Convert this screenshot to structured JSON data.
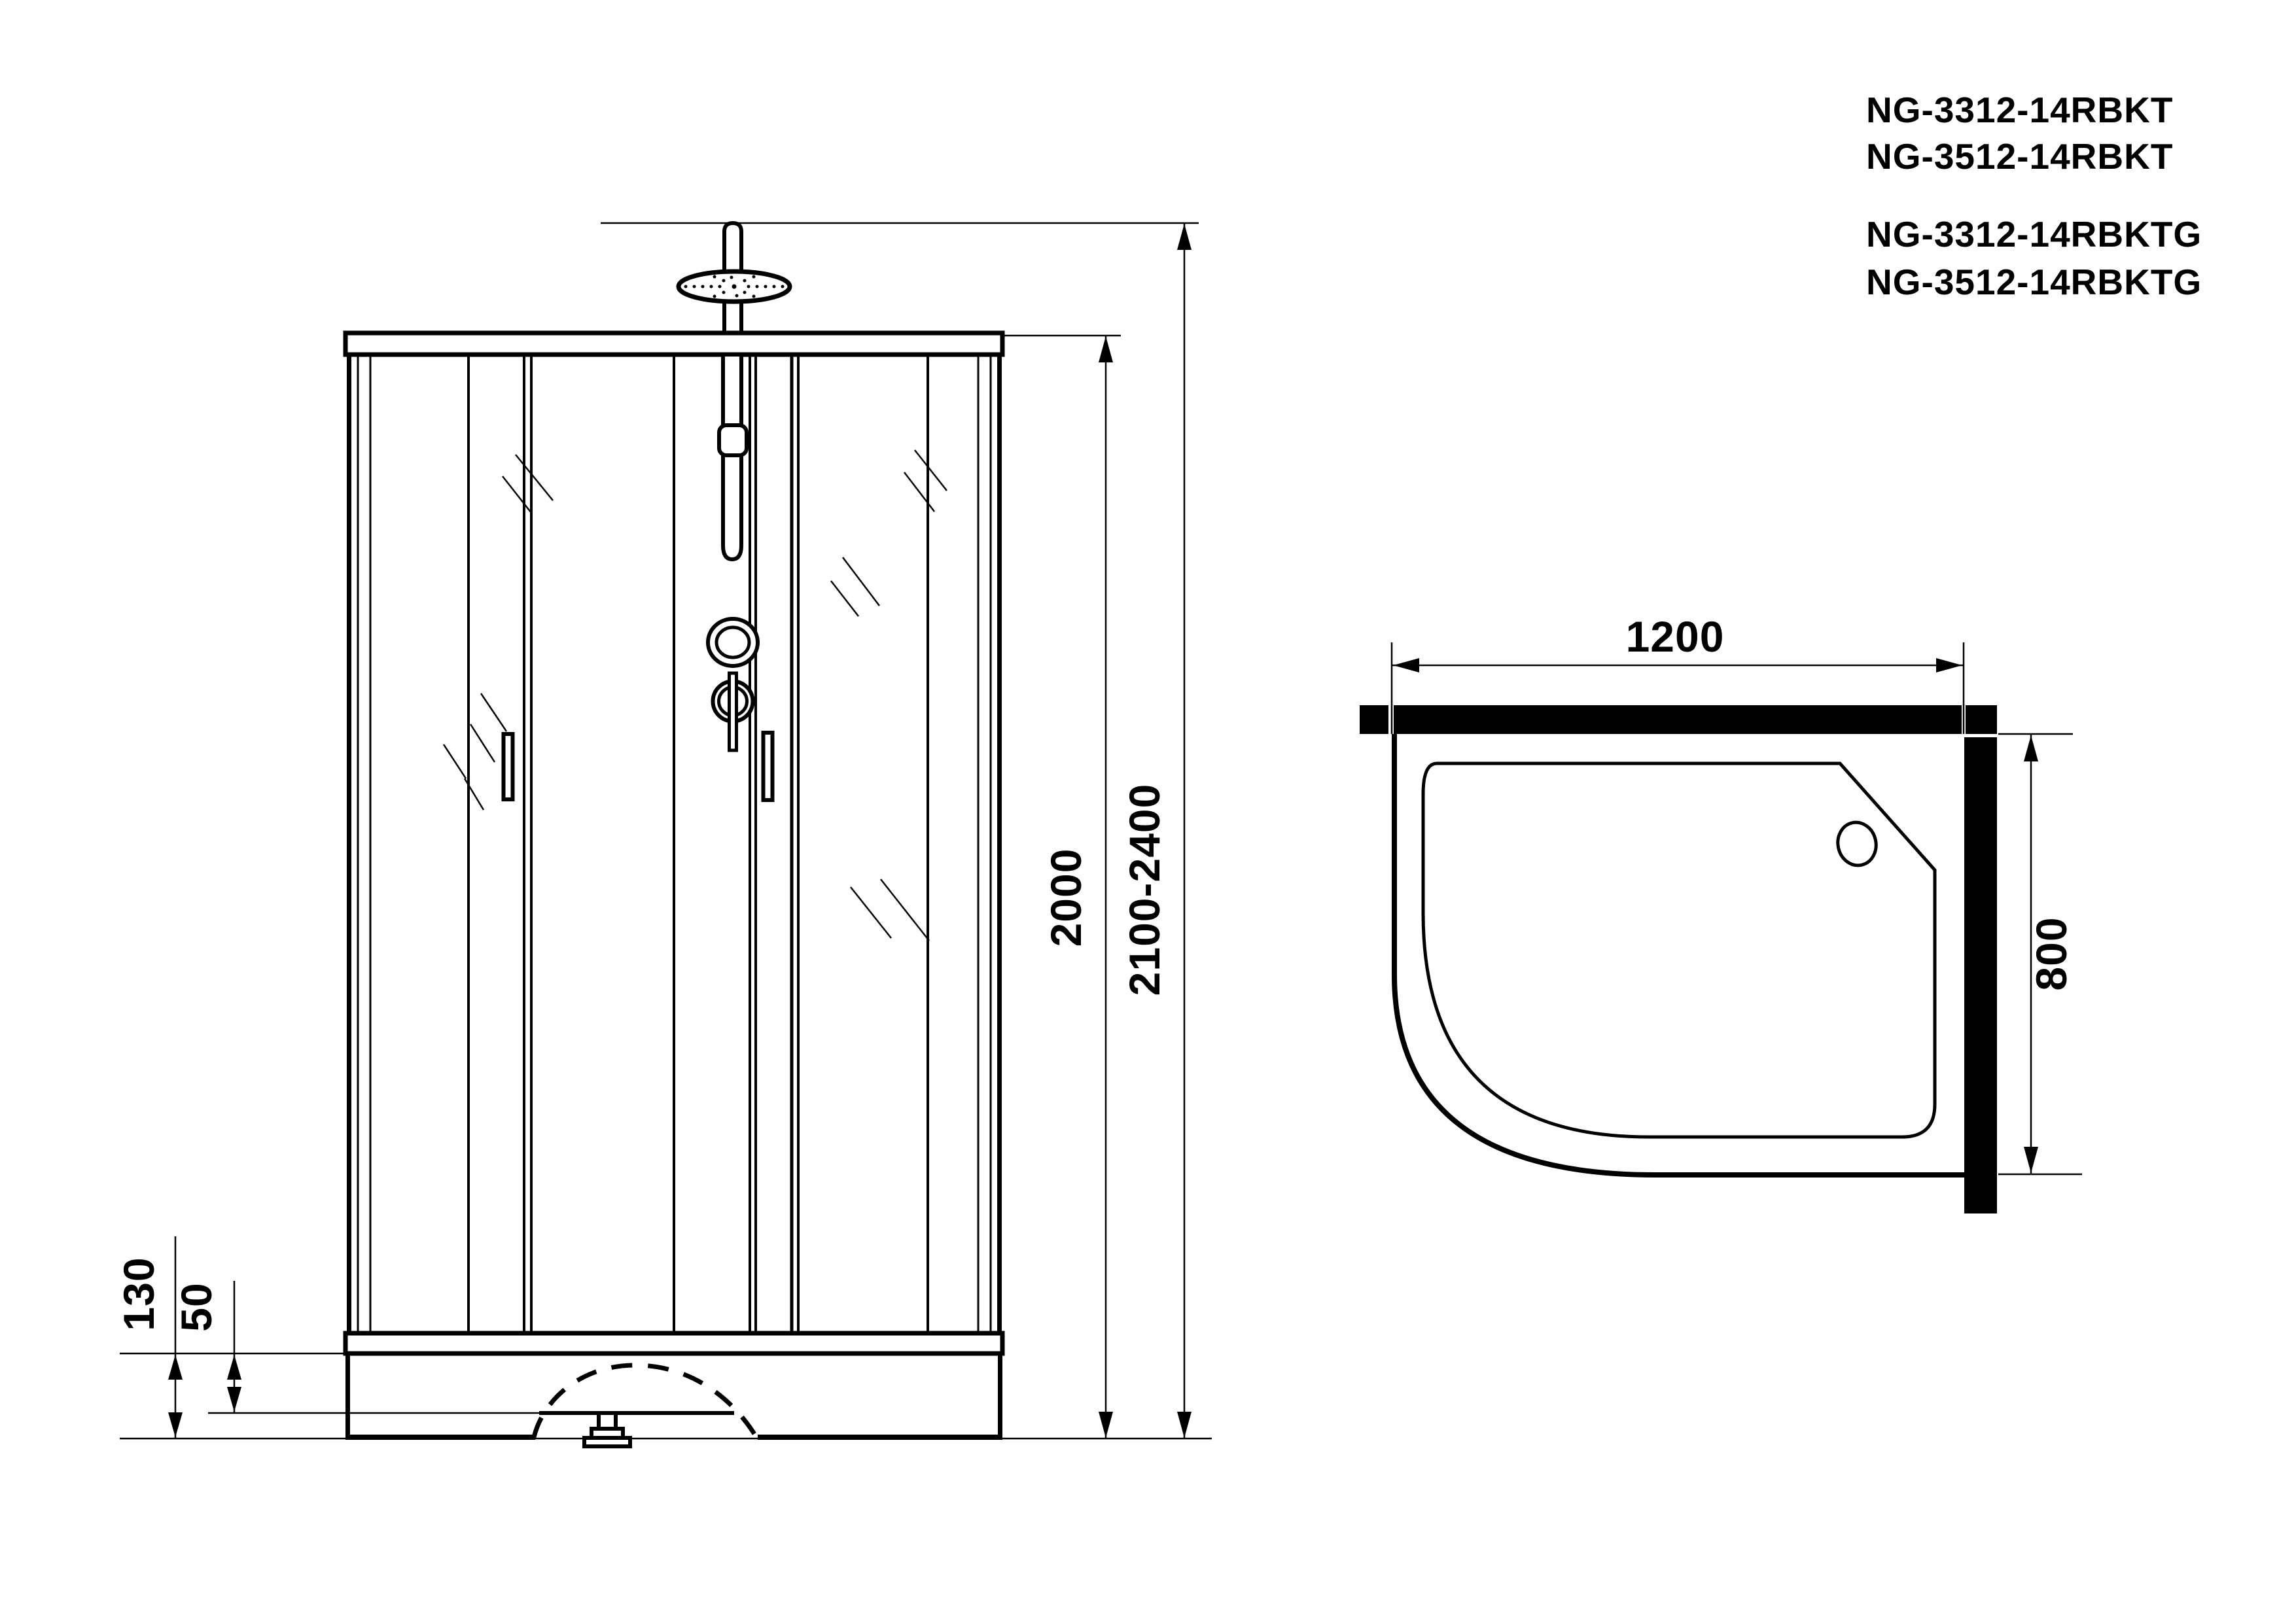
{
  "page": {
    "background_color": "#ffffff",
    "line_color": "#000000",
    "description": "Technical drawing of shower cabin: front elevation and plan view of quarter-round tray"
  },
  "models": {
    "group_rbkt": [
      "NG-3312-14RBKT",
      "NG-3512-14RBKT"
    ],
    "group_rbktg": [
      "NG-3312-14RBKTG",
      "NG-3512-14RBKTG"
    ]
  },
  "front_view": {
    "dims": {
      "inner_height": "2000",
      "total_height": "2100-2400",
      "tray_height": "130",
      "tray_depth": "50"
    }
  },
  "plan_view": {
    "dims": {
      "width": "1200",
      "depth": "800"
    }
  }
}
